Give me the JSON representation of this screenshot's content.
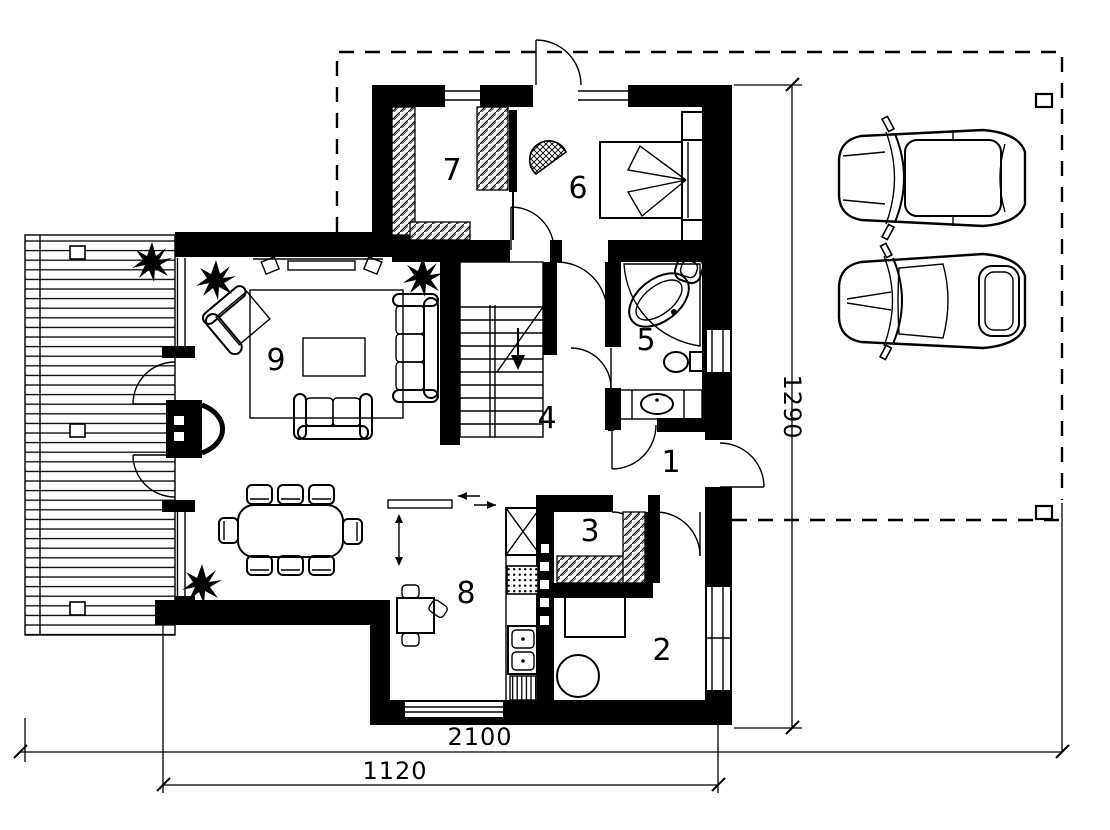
{
  "plan": {
    "rooms": [
      {
        "id": "1",
        "label": "1"
      },
      {
        "id": "2",
        "label": "2"
      },
      {
        "id": "3",
        "label": "3"
      },
      {
        "id": "4",
        "label": "4"
      },
      {
        "id": "5",
        "label": "5"
      },
      {
        "id": "6",
        "label": "6"
      },
      {
        "id": "7",
        "label": "7"
      },
      {
        "id": "8",
        "label": "8"
      },
      {
        "id": "9",
        "label": "9"
      }
    ],
    "dimensions": {
      "overall_width": "2100",
      "house_width": "1120",
      "side_height": "1290"
    },
    "colors": {
      "ink": "#000000",
      "paper": "#ffffff"
    }
  }
}
